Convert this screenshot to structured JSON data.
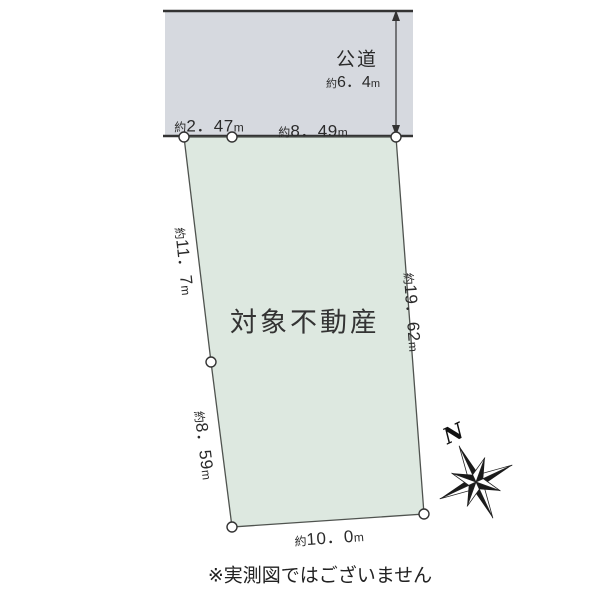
{
  "road": {
    "label": "公道",
    "width": {
      "prefix": "約",
      "value": "6．4",
      "unit": "m"
    }
  },
  "parcel": {
    "label": "対象不動産"
  },
  "dims": {
    "top_left": {
      "prefix": "約",
      "value": "2．47",
      "unit": "m"
    },
    "top_right": {
      "prefix": "約",
      "value": "8．49",
      "unit": "m"
    },
    "left_upper": {
      "prefix": "約",
      "value": "11．7",
      "unit": "m"
    },
    "left_lower": {
      "prefix": "約",
      "value": "8．59",
      "unit": "m"
    },
    "right_side": {
      "prefix": "約",
      "value": "19．62",
      "unit": "m"
    },
    "bottom": {
      "prefix": "約",
      "value": "10．0",
      "unit": "m"
    }
  },
  "compass": {
    "north_label": "N"
  },
  "footer": {
    "disclaimer": "※実測図ではございません"
  },
  "colors": {
    "road_fill": "#d6d9df",
    "parcel_fill": "#dde8e0",
    "line": "#333333",
    "marker_fill": "#ffffff"
  }
}
